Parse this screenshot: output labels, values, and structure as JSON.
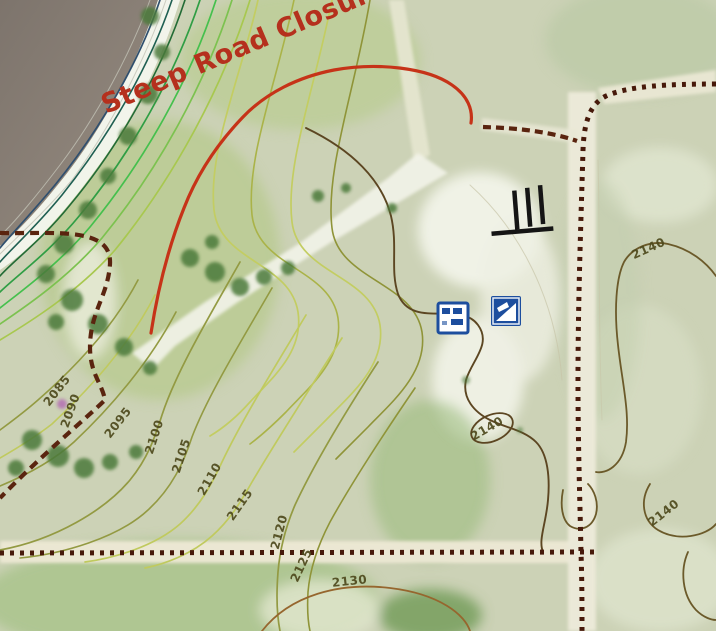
{
  "map": {
    "annotation": {
      "text": "Steep Road Closure"
    },
    "colors": {
      "closure_line": "#c63318",
      "closure_text": "#b5301d",
      "road_dash": "#5a240f",
      "road_dot": "#47190a",
      "icon_blue": "#1d4e9e",
      "water": "#8a8078",
      "contour_yellow": "#c0ca5e",
      "contour_olive": "#939a42",
      "contour_brown": "#96662e",
      "contour_index_dark": "#5c4622"
    },
    "contour_labels": [
      {
        "value": "2085"
      },
      {
        "value": "2090"
      },
      {
        "value": "2095"
      },
      {
        "value": "2100"
      },
      {
        "value": "2105"
      },
      {
        "value": "2110"
      },
      {
        "value": "2115"
      },
      {
        "value": "2120"
      },
      {
        "value": "2125"
      },
      {
        "value": "2130"
      },
      {
        "value": "2140"
      },
      {
        "value": "2140"
      },
      {
        "value": "2140"
      }
    ],
    "symbols": [
      {
        "name": "dock-symbol"
      },
      {
        "name": "recreation-site-icon"
      },
      {
        "name": "boat-ramp-icon"
      }
    ]
  }
}
